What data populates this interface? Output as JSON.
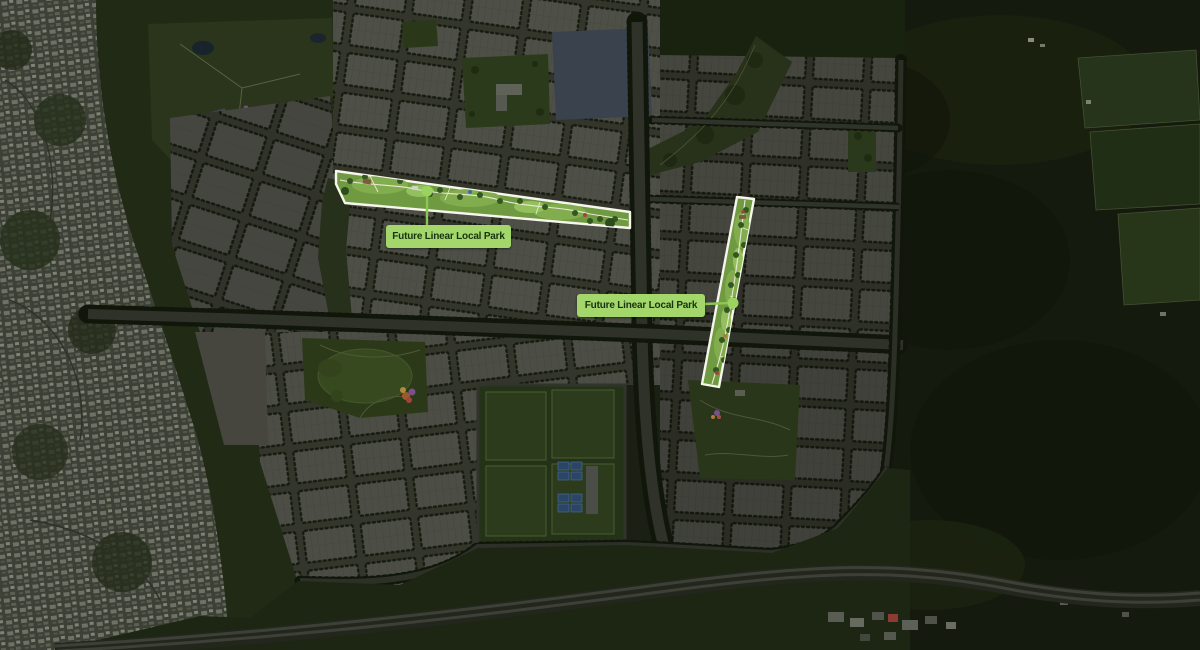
{
  "map": {
    "type": "aerial-masterplan-render",
    "description": "Darkened aerial masterplan of a new residential community with two highlighted linear park corridors",
    "annotations": [
      {
        "id": "park1",
        "label": "Future Linear Local Park"
      },
      {
        "id": "park2",
        "label": "Future Linear Local Park"
      }
    ],
    "colors": {
      "label_background": "#a3d66b",
      "label_text": "#17330f",
      "highlight_outline": "#f6f6ec",
      "highlight_fill": "#6f9a42",
      "marker_fill": "#9bd35f",
      "callout_line": "#8cc653"
    }
  }
}
